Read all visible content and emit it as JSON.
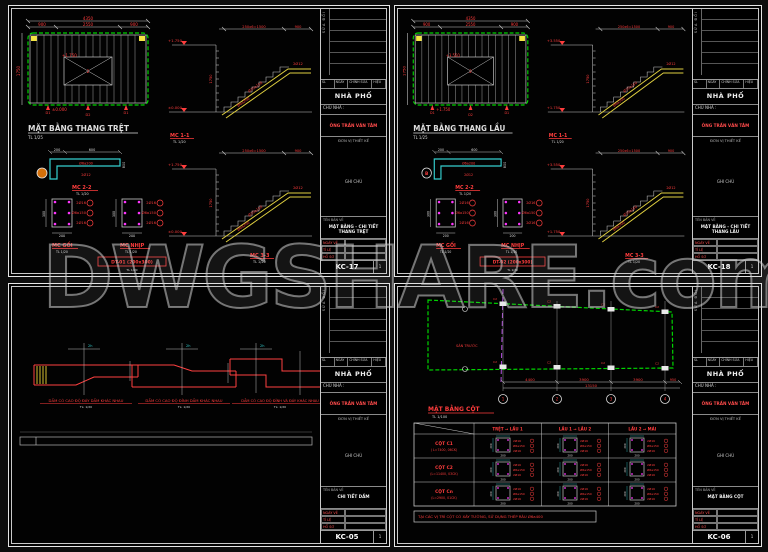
{
  "watermark": "DWGSHARE.com",
  "colors": {
    "green": "#00d400",
    "yellow": "#f5e642",
    "cyan": "#35d0d0",
    "red": "#ff3d3d",
    "magenta": "#ff35ff",
    "purple": "#b44fe0",
    "orange": "#d4700a"
  },
  "titleblock": {
    "rev_side": "SỬA ĐỔI",
    "rev_headers": [
      "SL",
      "NGÀY",
      "CHỈNH SỬA",
      "HIỆU"
    ],
    "project": "NHÀ PHỐ",
    "owner_label": "CHỦ NHÀ :",
    "owner_name": "ÔNG TRẦN VĂN TÂM",
    "design_label": "ĐƠN VỊ THIẾT KẾ",
    "note_label": "GHI CHÚ",
    "name_label": "TÊN BẢN VẼ",
    "foot_labels": [
      "NGÀY VẼ",
      "TỈ LỆ",
      "HỒ SƠ"
    ],
    "page": "1"
  },
  "stair_plan": {
    "total": "4350",
    "segs": [
      "900",
      "2550",
      "900"
    ],
    "side": "1750",
    "cut_mark": "2",
    "tags": [
      "D1",
      "D2",
      "D1"
    ]
  },
  "stair_sec": {
    "top_dim": "250x6=1500",
    "land_dim": "900",
    "bar1": "Ø10a150",
    "bar2": "Ø6a200",
    "bar3": "2Ø12",
    "rise": "1750"
  },
  "rebar_sec": {
    "top": "2Ø16",
    "mid": "Ø6a150",
    "bot": "2Ø16",
    "w": "200",
    "h": "300"
  },
  "sheets": {
    "tl": {
      "plan_title": "MẶT BẰNG THANG TRỆT",
      "plan_scale": "TL 1/25",
      "level_top": "+1.750",
      "level_bot": "±0.000",
      "mc11": "MC 1-1",
      "mc22": "MC 2-2",
      "mc33": "MC 3-3",
      "mc_goi": "MC GỐI",
      "mc_nhip": "MC NHỊP",
      "scale20": "TL 1/20",
      "dt": "DT-01 (200x300)",
      "dt_sub": "TL 1/20",
      "mc22_dims": [
        "200",
        "600",
        "800"
      ],
      "mc22_bars": [
        "Ø6a200",
        "2Ø12"
      ],
      "drawing_name": "MẶT BẰNG - CHI TIẾT THANG TRỆT",
      "sheet_no": "KC-17"
    },
    "tr": {
      "plan_title": "MẶT BẰNG THANG LẦU",
      "plan_scale": "TL 1/25",
      "level_top": "+3.550",
      "level_bot": "+1.750",
      "mc11": "MC 1-1",
      "mc22": "MC 2-2",
      "mc33": "MC 3-3",
      "mc_goi": "MC GỐI",
      "mc_nhip": "MC NHỊP",
      "scale20": "TL 1/20",
      "dt": "DT-02 (200x300)",
      "dt_sub": "TL 1/20",
      "mc22_dims": [
        "200",
        "600",
        "800"
      ],
      "mc22_bars": [
        "Ø6a200",
        "2Ø12"
      ],
      "bubble": "B",
      "drawing_name": "MẶT BẰNG - CHI TIẾT THANG LẦU",
      "sheet_no": "KC-18"
    },
    "bl": {
      "captions": [
        "DẦM CÓ CAO ĐỘ ĐÁY DẦM KHÁC NHAU",
        "DẦM CÓ CAO ĐỘ ĐỈNH DẦM KHÁC NHAU",
        "DẦM CÓ CAO ĐỘ ĐỈNH VÀ ĐÁY KHÁC NHAU"
      ],
      "scale": "TL: 1/20",
      "hatch_label": "2h",
      "drawing_name": "CHI TIẾT DẦM",
      "sheet_no": "KC-05"
    },
    "br": {
      "plan": {
        "title": "MẶT BẰNG CỘT",
        "scale": "TL 1/100",
        "dims": [
          "4400",
          "3900",
          "3900"
        ],
        "dim_right": "950",
        "total": "13150",
        "bubbles": [
          "1",
          "2",
          "3",
          "4"
        ],
        "area_label": "SÂN TRƯỚC",
        "col_tag": "C2"
      },
      "table": {
        "headers": [
          "TRỆT → LẦU 1",
          "LẦU 1 → LẦU 2",
          "LẦU 2 → MÁI"
        ],
        "rows": [
          {
            "name": "CỘT C1",
            "spec": "( L=7400, 06CK)"
          },
          {
            "name": "CỘT C2",
            "spec": "(L=11400, 03CK)"
          },
          {
            "name": "CỘT Cn",
            "spec": "(L=2900, 01CK)"
          }
        ],
        "cell": {
          "top": "2Ø16",
          "mid": "Ø6a150",
          "bot": "2Ø16",
          "dim_w": "200",
          "dim_h": "200"
        },
        "note": "TẠI CÁC VỊ TRÍ CỘT CÓ XÂY TƯỜNG, SỬ DỤNG THÉP RÂU Ø6a400"
      },
      "drawing_name": "MẶT BẰNG CỘT",
      "sheet_no": "KC-06"
    }
  }
}
